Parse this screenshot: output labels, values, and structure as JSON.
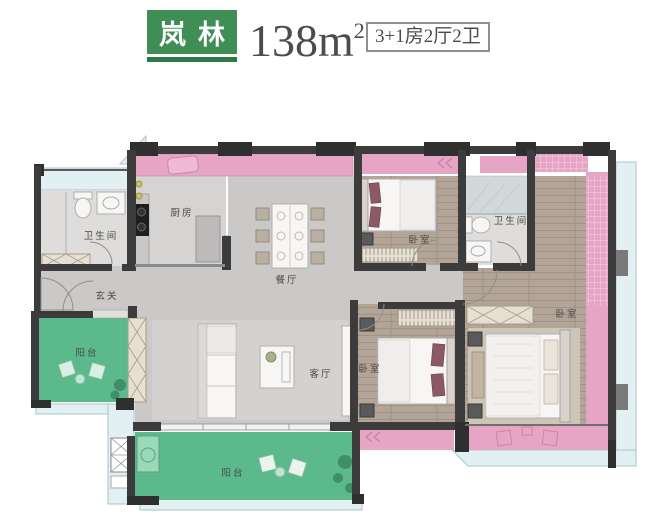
{
  "header": {
    "brand": "岚林",
    "area_value": "138m",
    "area_sup": "2",
    "layout_spec": "3+1房2厅2卫"
  },
  "colors": {
    "brand_green": "#3e8e55",
    "brand_green_dark": "#2e7a46",
    "text_dark": "#4c4c4c",
    "wall": "#3c3c3c",
    "pink_bay": "#e6a5c5",
    "balcony_green": "#5cb98c",
    "balcony_green_light": "#9ad9b8",
    "wood_floor": "#b2a496",
    "tile_gray": "#cbc9c7",
    "window_blue": "#e3f0f2"
  },
  "plan": {
    "rooms": {
      "foyer": {
        "label": "玄关"
      },
      "kitchen": {
        "label": "厨房"
      },
      "dining": {
        "label": "餐厅"
      },
      "living": {
        "label": "客厅"
      },
      "bath1": {
        "label": "卫生间"
      },
      "bath2": {
        "label": "卫生间"
      },
      "bedroom_top": {
        "label": "卧室"
      },
      "bedroom_bottom": {
        "label": "卧室"
      },
      "bedroom_master": {
        "label": "卧室"
      },
      "balcony_left": {
        "label": "阳台"
      },
      "balcony_bottom": {
        "label": "阳台"
      }
    }
  }
}
